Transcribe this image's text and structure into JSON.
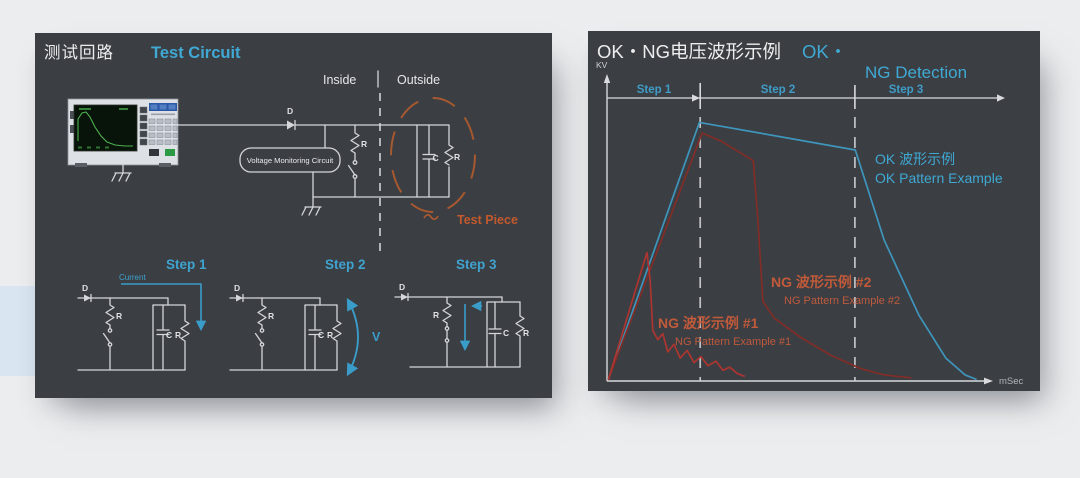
{
  "background": {
    "page_color": "#ecedee",
    "accent_color": "#d9e5f1",
    "panel_color": "#3b3e43"
  },
  "left_panel": {
    "title_zh": "测试回路",
    "title_en": "Test Circuit",
    "region_labels": {
      "inside": "Inside",
      "outside": "Outside"
    },
    "monitor_box_label": "Voltage Monitoring Circuit",
    "test_piece_label": "Test Piece",
    "component_labels": {
      "diode": "D",
      "resistor": "R",
      "capacitor": "C"
    },
    "steps": {
      "step1": {
        "label": "Step 1",
        "current_label": "Current"
      },
      "step2": {
        "label": "Step 2",
        "voltage_label": "V"
      },
      "step3": {
        "label": "Step 3"
      }
    }
  },
  "right_panel": {
    "title_zh": "OK・NG电压波形示例",
    "title_accent": "OK・",
    "title_en": "NG Detection",
    "y_axis_label": "KV",
    "x_axis_label": "mSec",
    "step_labels": [
      "Step 1",
      "Step 2",
      "Step 3"
    ],
    "annotations": {
      "ok_zh": "OK 波形示例",
      "ok_en": "OK Pattern Example",
      "ng2_zh": "NG 波形示例 #2",
      "ng2_en": "NG Pattern Example #2",
      "ng1_zh": "NG 波形示例 #1",
      "ng1_en": "NG Pattern Example #1"
    }
  },
  "chart_data": {
    "type": "line",
    "title": "OK・NG电压波形示例 / OK・NG Detection",
    "xlabel": "mSec",
    "ylabel": "KV",
    "x_range": [
      0,
      104
    ],
    "y_range": [
      0,
      100
    ],
    "grid": false,
    "legend_position": "inline annotations",
    "step_boundaries_x": [
      24.2,
      64.4
    ],
    "series": [
      {
        "name": "OK Pattern Example",
        "color": "#3e96bd",
        "points": [
          [
            0.3,
            0.3
          ],
          [
            24,
            84.5
          ],
          [
            64.5,
            75.5
          ],
          [
            72,
            46
          ],
          [
            81,
            21.5
          ],
          [
            88,
            7.5
          ],
          [
            93,
            2
          ],
          [
            96,
            0.5
          ]
        ]
      },
      {
        "name": "NG Pattern Example #2",
        "color": "#822d27",
        "points": [
          [
            0.3,
            0.3
          ],
          [
            24.7,
            81
          ],
          [
            29.5,
            78.5
          ],
          [
            38,
            72
          ],
          [
            39.2,
            52.5
          ],
          [
            40.5,
            26
          ],
          [
            43.5,
            20.5
          ],
          [
            50,
            14.5
          ],
          [
            58,
            8.5
          ],
          [
            66,
            4
          ],
          [
            72,
            2
          ],
          [
            79,
            1
          ]
        ]
      },
      {
        "name": "NG Pattern Example #1",
        "color": "#ad3530",
        "points": [
          [
            0.3,
            0.3
          ],
          [
            9.4,
            38
          ],
          [
            10.4,
            42
          ],
          [
            11.2,
            33
          ],
          [
            11.9,
            16.5
          ],
          [
            13.2,
            13.5
          ],
          [
            14.5,
            15.5
          ],
          [
            15.8,
            9.5
          ],
          [
            17.4,
            12
          ],
          [
            19,
            7.5
          ],
          [
            20.8,
            10
          ],
          [
            22.6,
            6
          ],
          [
            24.4,
            8
          ],
          [
            26.2,
            5
          ],
          [
            28.3,
            6.5
          ],
          [
            30.1,
            3.5
          ],
          [
            31.9,
            4.5
          ],
          [
            33.8,
            2.5
          ],
          [
            35.8,
            1.5
          ]
        ]
      }
    ]
  }
}
